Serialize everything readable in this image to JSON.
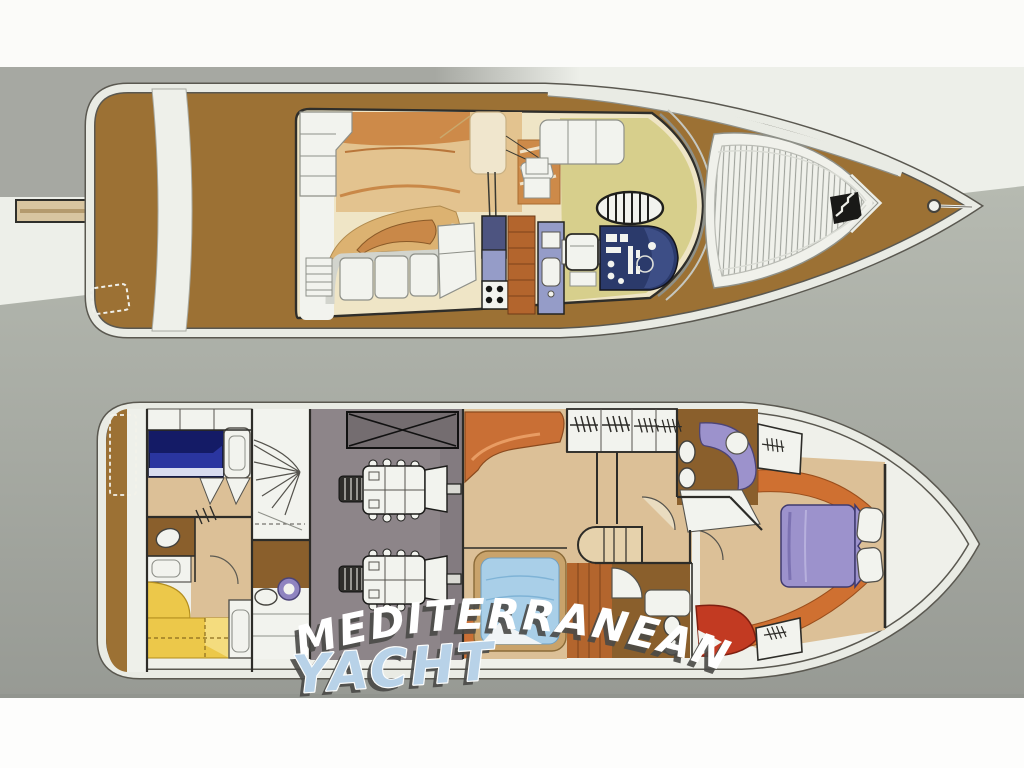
{
  "watermark": {
    "line1": "MEDITERRANEAN",
    "line2": "YACHT"
  },
  "colors": {
    "paper": "#edefe9",
    "photo_band_top": "#fbfbf9",
    "photo_band_bottom": "#fdfdfc",
    "gray_band": "#a6a8a2",
    "floor_gray_top": "#b6bab1",
    "floor_gray_bottom": "#979a94",
    "hull_brown": "#9c7134",
    "outline_dark": "#33322e",
    "rim_white": "#eef0ea",
    "flybridge_cream": "#efe5c6",
    "sunpad_tan": "#e3c38f",
    "cushion_orange": "#cd8a49",
    "lounge_tan": "#dcb271",
    "helm_khaki": "#d7cf8c",
    "wood_sole": "#b3652d",
    "galley_navy": "#4d5480",
    "counter_periwinkle": "#959cc8",
    "console_navy": "#2b3a6b",
    "furniture_white": "#f2f3ee",
    "teak_line": "#9fa29b",
    "engine_room_gray": "#8d8589",
    "hatch_gray": "#746d70",
    "bed_blue": "#2a35a0",
    "berth_sky_blue": "#a9cfe8",
    "berth_frame_tan": "#c9a36b",
    "cabin_floor_tan": "#dcc097",
    "bath_floor_brown": "#8a5f2c",
    "bunk_yellow": "#ecc84a",
    "salon_sofa_orange": "#c96f35",
    "bow_trim_orange": "#cf7031",
    "vip_counter_purple": "#9c92cc",
    "sink_purple": "#8f84c0",
    "bow_bed_lavender": "#9c92cc",
    "settee_red": "#c23a22",
    "watermark_white": "#ffffff",
    "watermark_blue": "#b8d2e8",
    "watermark_shadow": "#4a4a47"
  }
}
